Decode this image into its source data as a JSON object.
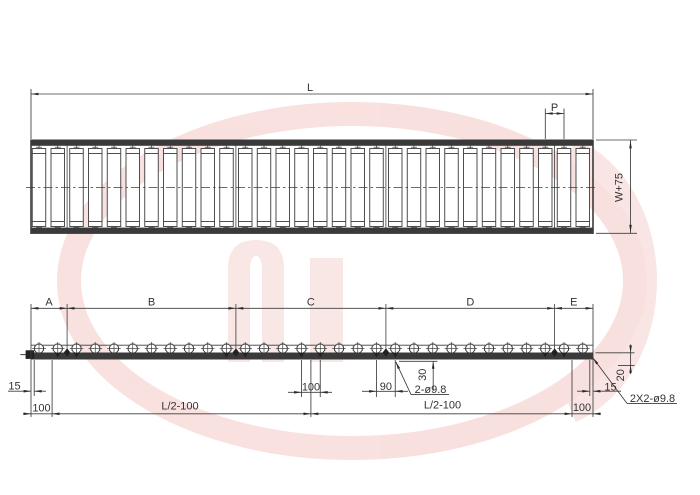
{
  "top_view": {
    "length_label": "L",
    "pitch_label": "P",
    "frame_width_label": "W+75",
    "roller_count": 30
  },
  "side_view": {
    "section_labels": [
      "A",
      "B",
      "C",
      "D",
      "E"
    ],
    "dims": {
      "left_end_to_hole": "15",
      "left_end_hole_offset": "100",
      "left_half_length": "L/2-100",
      "center_hole_spacing": "100",
      "splice_hole_spacing": "90",
      "hole_offset_vertical": "30",
      "splice_holes_note": "2-ø9.8",
      "right_half_length": "L/2-100",
      "right_end_hole_offset": "100",
      "right_end_to_hole": "15",
      "right_hole_depth": "20",
      "end_holes_note": "2X2-ø9.8"
    }
  },
  "watermark": {
    "ring_color": "#efb7b2",
    "letter_color": "#f3c8c4"
  },
  "line_color": "#3c3c3c",
  "rail_color": "#3a3a3a"
}
